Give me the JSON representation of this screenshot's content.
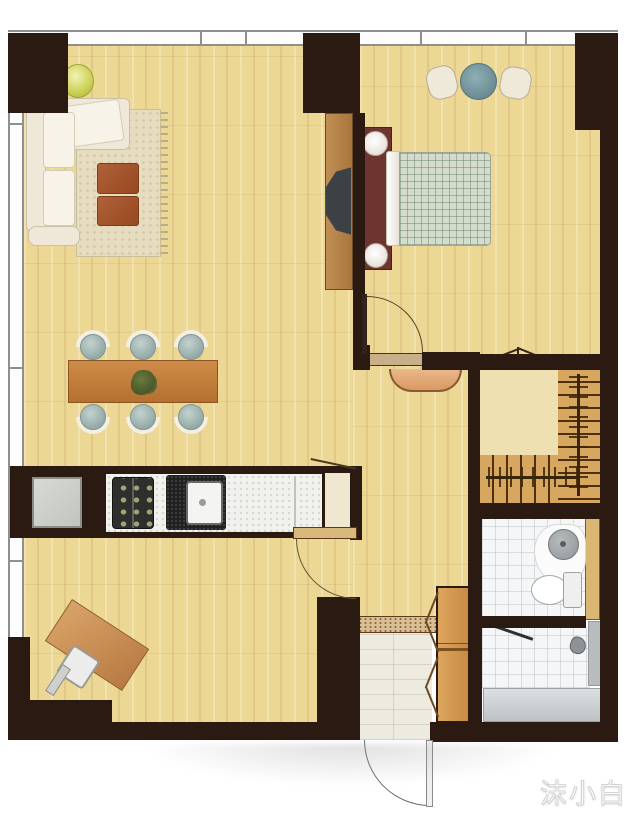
{
  "watermark": {
    "text": "沫小白"
  },
  "plan": {
    "type": "apartment-floor-plan",
    "rooms": [
      {
        "name": "living-room",
        "furniture": [
          "l-sofa",
          "area-rug",
          "ottoman",
          "ottoman",
          "plant",
          "tv-panel"
        ]
      },
      {
        "name": "dining-area",
        "furniture": [
          "dining-table",
          "dining-chair x6",
          "table-centerpiece"
        ]
      },
      {
        "name": "bedroom",
        "furniture": [
          "double-bed",
          "bedside-lamp x2",
          "pouf x2",
          "round-side-table"
        ]
      },
      {
        "name": "kitchen",
        "furniture": [
          "fridge",
          "stove",
          "sink",
          "counter"
        ]
      },
      {
        "name": "study-corner",
        "furniture": [
          "desk",
          "desk-chair"
        ]
      },
      {
        "name": "entry-foyer",
        "furniture": [
          "wardrobe-folding-doors",
          "threshold",
          "entry-door"
        ]
      },
      {
        "name": "bathroom",
        "furniture": [
          "washbasin",
          "toilet",
          "shower",
          "bench"
        ]
      },
      {
        "name": "staircase",
        "furniture": [
          "l-shaped-stairs",
          "landing"
        ]
      }
    ],
    "colors": {
      "wall": "#2b1a11",
      "floor_wood": "#ecd795",
      "stair_wood": "#d7a75f",
      "landing": "#efe0b2",
      "closet_wood": "#d19350",
      "table_wood": "#c07e3e",
      "accent_teal": "#7597a0",
      "ottoman_brown": "#a2542c",
      "headboard_maroon": "#6d3430",
      "blanket_plaid": "#d4dccc",
      "tile_white": "#f5f6f7",
      "window_line": "#8f8f8f"
    }
  }
}
